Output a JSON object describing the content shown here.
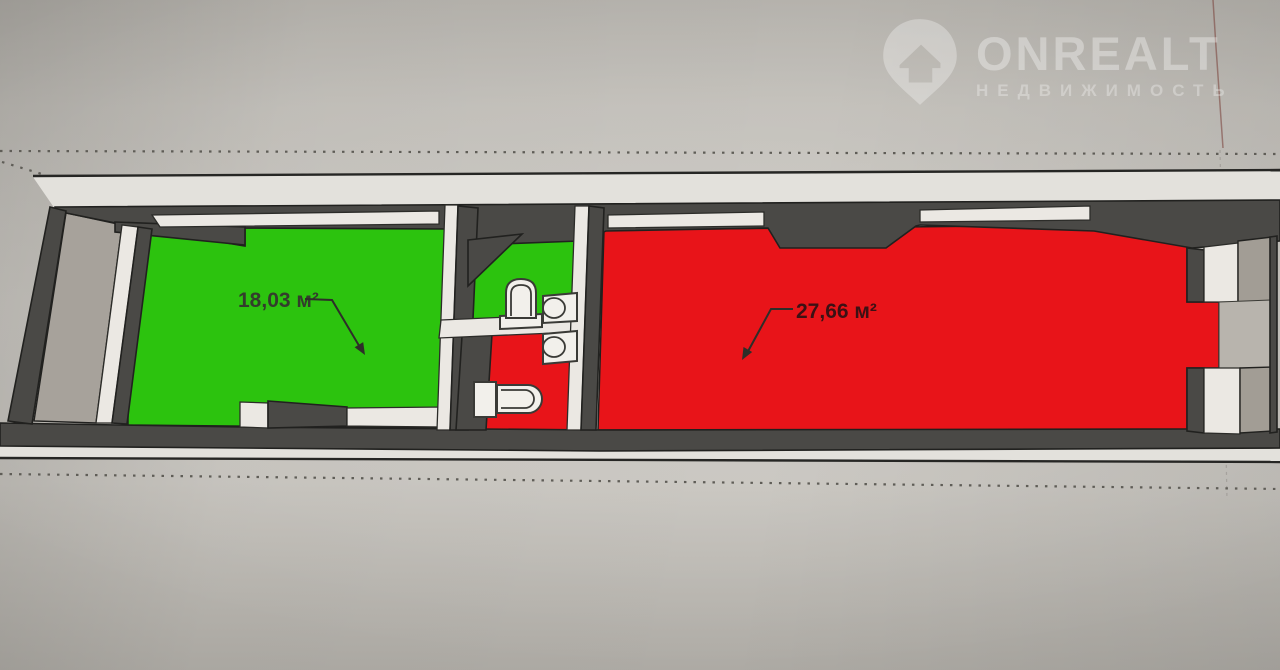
{
  "watermark": {
    "brand": "ONREALT",
    "subtitle": "НЕДВИЖИМОСТЬ",
    "icon": "house-location-pin"
  },
  "floorplan": {
    "rooms": [
      {
        "name": "left-room",
        "area_label": "18,03 м²",
        "floor_color": "#2cc30e"
      },
      {
        "name": "right-room",
        "area_label": "27,66 м²",
        "floor_color": "#e81419"
      }
    ],
    "bathroom_fixtures": [
      "toilet-top-view",
      "sink",
      "sink",
      "toilet-side-view"
    ],
    "colors": {
      "wall_dark": "#4a4946",
      "wall_light": "#ebe8e3",
      "entry_floor": "#a7a29b",
      "outline": "#21211f",
      "background": "#c4c1bb",
      "label_green_text": "#333d2c",
      "label_red_text": "#3c1114"
    }
  }
}
